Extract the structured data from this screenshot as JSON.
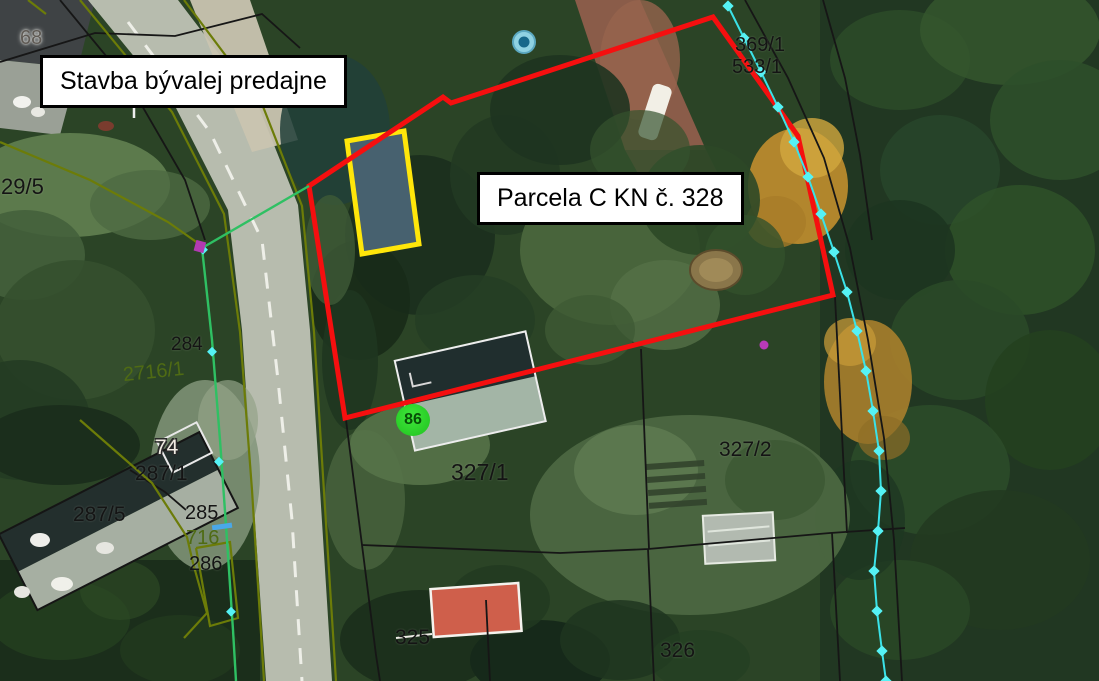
{
  "callouts": {
    "building": "Stavba bývalej predajne",
    "parcel": "Parcela C KN č. 328"
  },
  "parcel_numbers": {
    "n68": "68",
    "n29_5": "29/5",
    "n284": "284",
    "n2716_1": "2716/1",
    "n74": "74",
    "n287_1": "287/1",
    "n287_5": "287/5",
    "n285": "285",
    "n716": "716",
    "n286": "286",
    "n327_1": "327/1",
    "n327_2": "327/2",
    "n325": "325",
    "n326": "326",
    "n369_1": "369/1",
    "n533_1": "533/1"
  },
  "building_badge": "86",
  "legend_colors": {
    "parcel_boundary_red": "#f50f0f",
    "building_highlight_yellow": "#ffe60a",
    "utility_line_cyan": "#3ae2e8",
    "boundary_line_green": "#2fc063",
    "boundary_line_olive": "#6c7c08",
    "badge_green": "#2ed829"
  }
}
